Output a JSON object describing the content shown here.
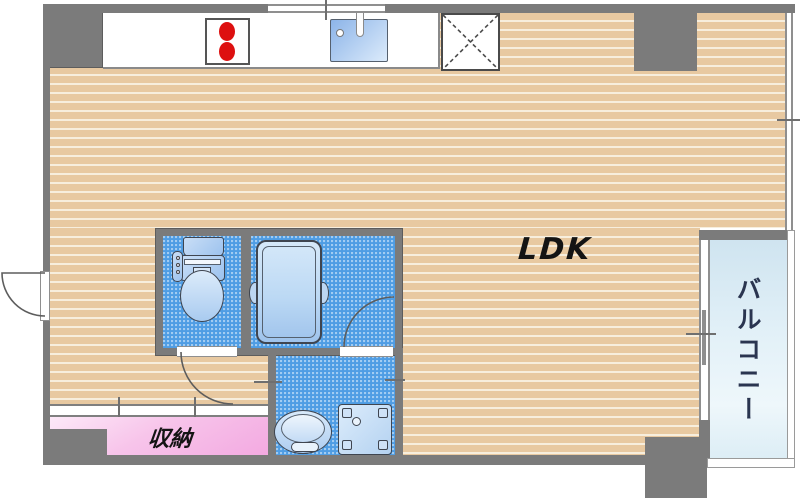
{
  "labels": {
    "ldk": "LDK",
    "storage": "収納",
    "balcony": "バルコニー"
  },
  "colors": {
    "wall_gray": "#7b7b7b",
    "wood_floor_tan": "#e8c9a1",
    "wood_floor_stripe": "#f7eedd",
    "wet_area_blue": "#4f9de4",
    "fixture_blue_light": "#c9def6",
    "storage_pink": "#f3a9e1",
    "balcony_blue": "#d7e9f3",
    "burner_red": "#dd1010",
    "label_dark": "#141414",
    "balcony_label_navy": "#2a3550"
  },
  "fixture_icons": [
    "stove-burners-icon",
    "kitchen-sink-icon",
    "faucet-icon",
    "refrigerator-space-icon",
    "toilet-icon",
    "bathtub-icon",
    "washbasin-icon",
    "washing-machine-pan-icon",
    "door-swing-icon",
    "window-icon"
  ]
}
